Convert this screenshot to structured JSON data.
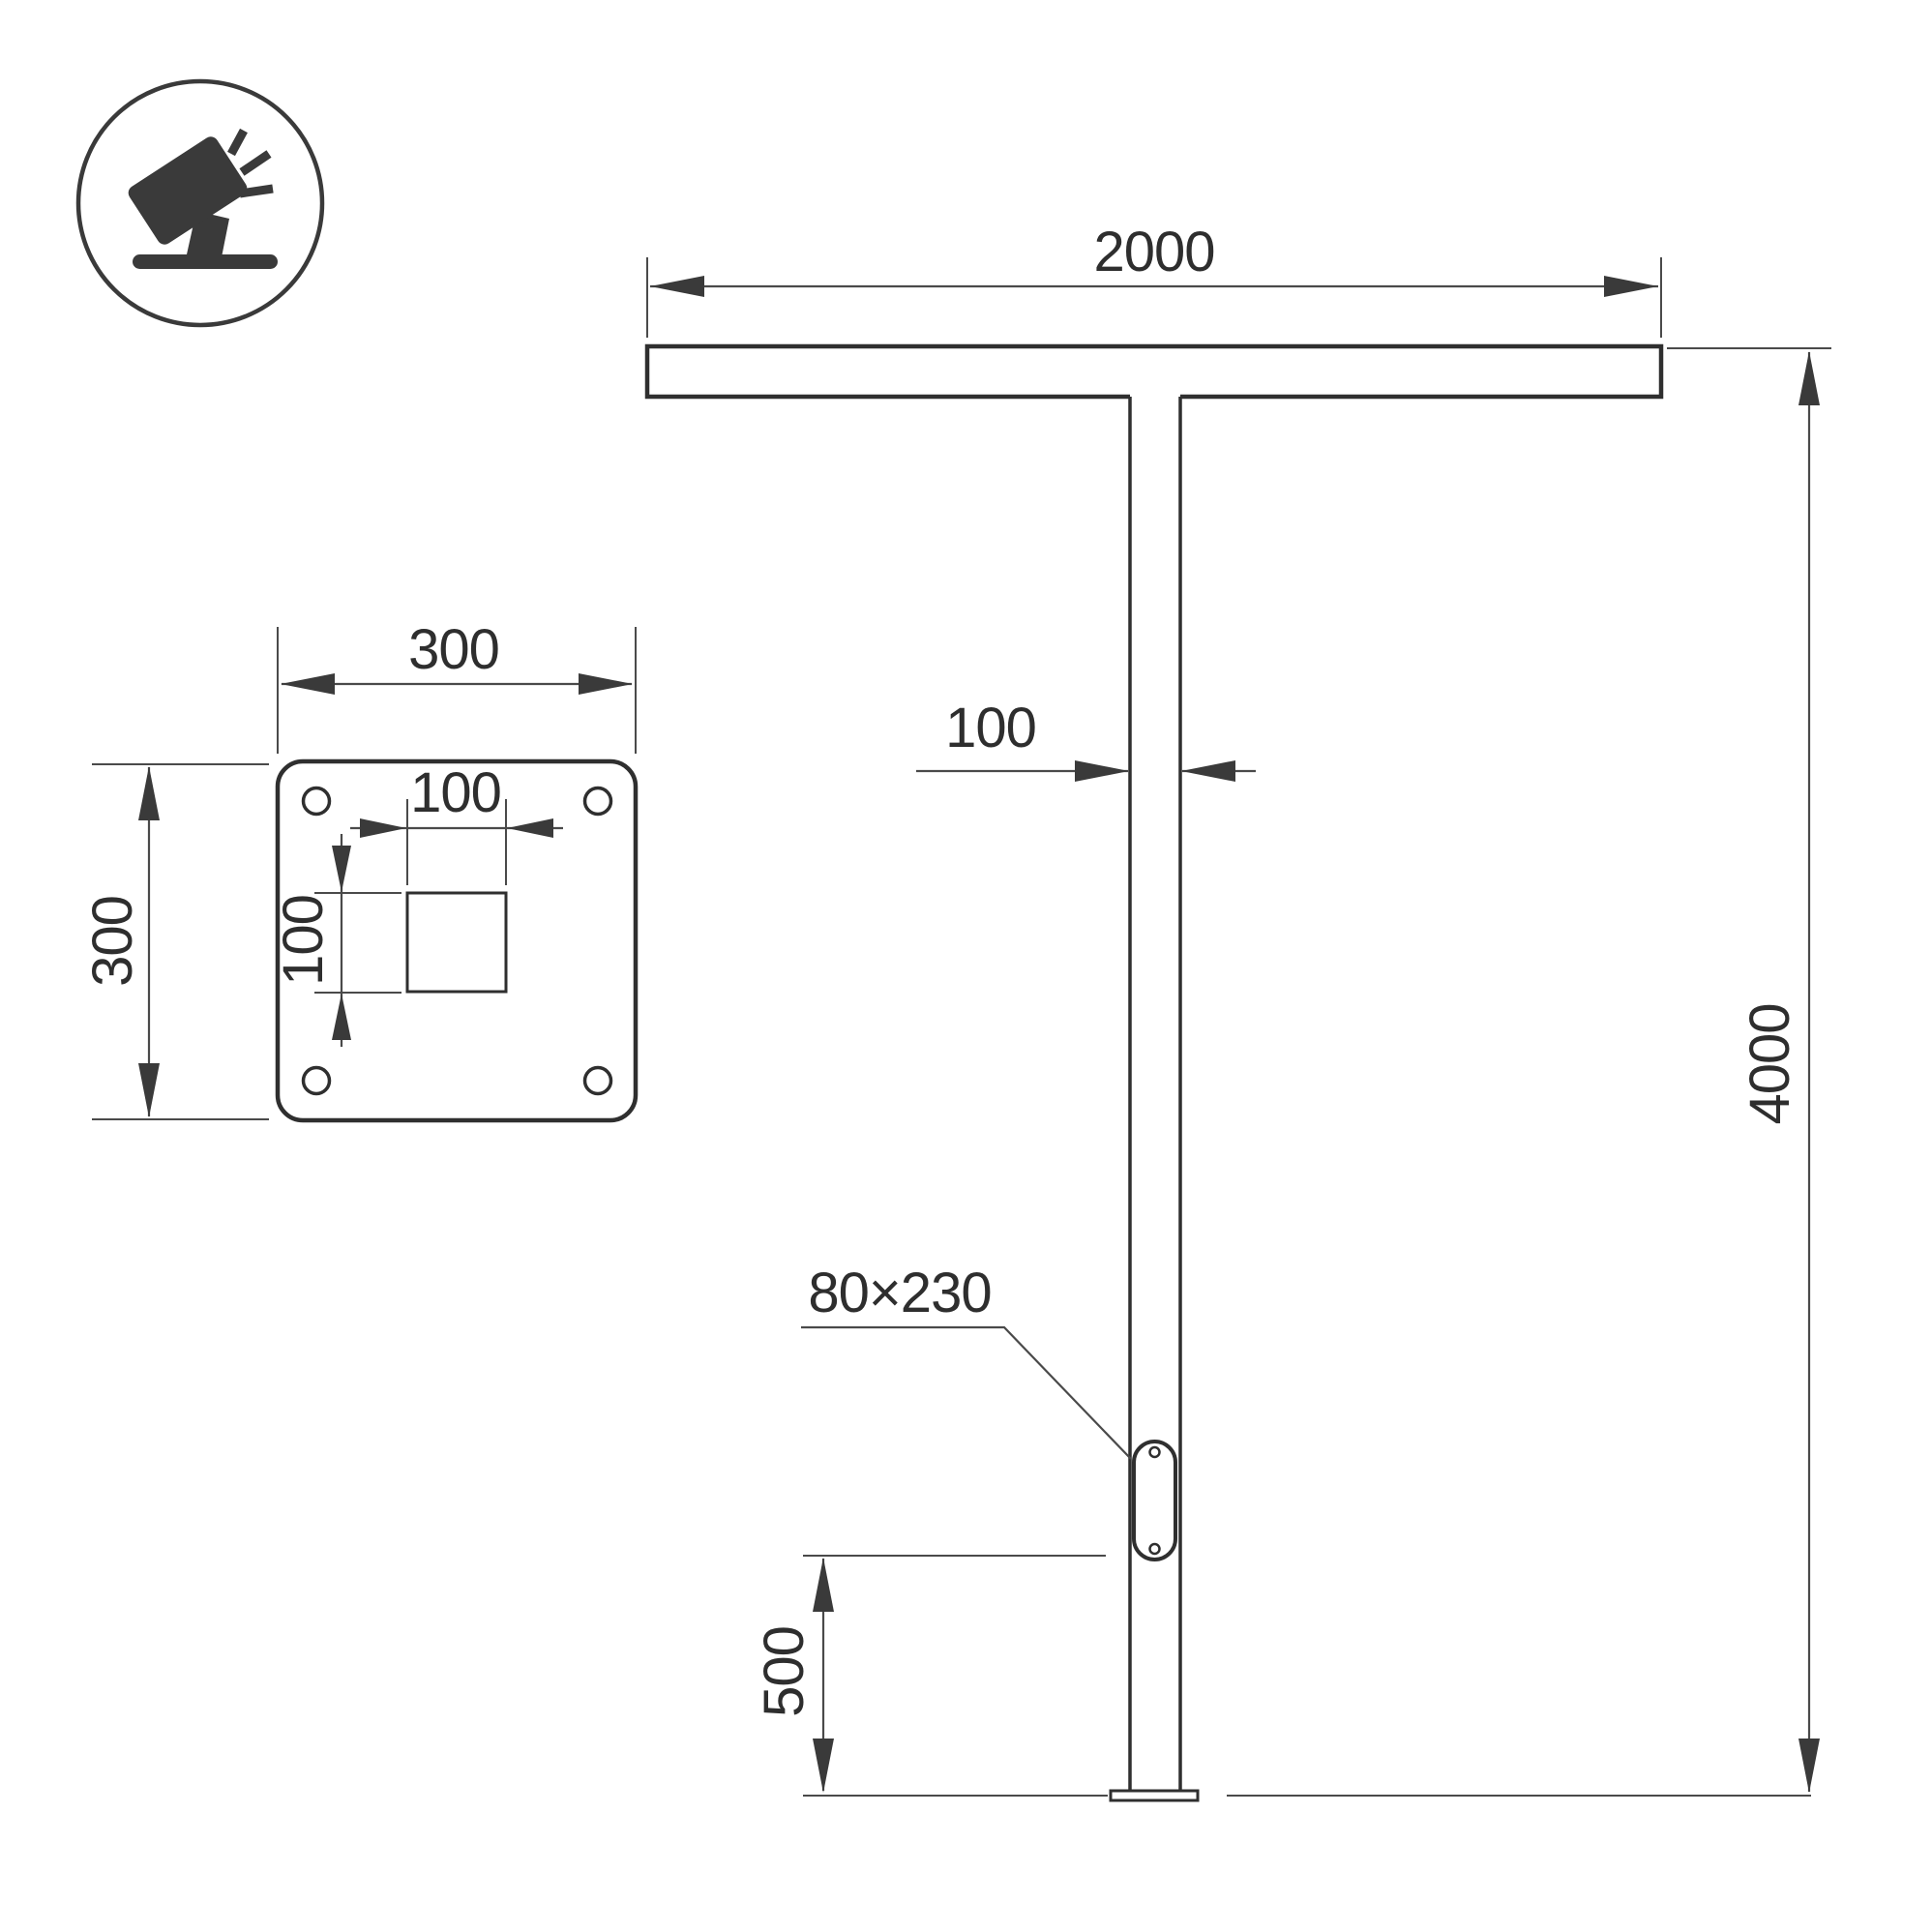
{
  "drawing": {
    "type": "technical-dimension-drawing",
    "elevation": {
      "top_bar_width_label": "2000",
      "pole_width_label": "100",
      "pole_height_label": "4000",
      "hatch_size_label": "80×230",
      "hatch_bottom_offset_label": "500"
    },
    "base_plate": {
      "plate_width_label": "300",
      "plate_height_label": "300",
      "cutout_width_label": "100",
      "cutout_height_label": "100"
    },
    "icon": {
      "name": "tilted-floodlight-icon"
    },
    "colors": {
      "outline": "#2f2f2f",
      "dimension_line": "#4a4a4a",
      "text": "#2e2e2e",
      "icon": "#3a3a3a",
      "background": "#ffffff"
    }
  }
}
